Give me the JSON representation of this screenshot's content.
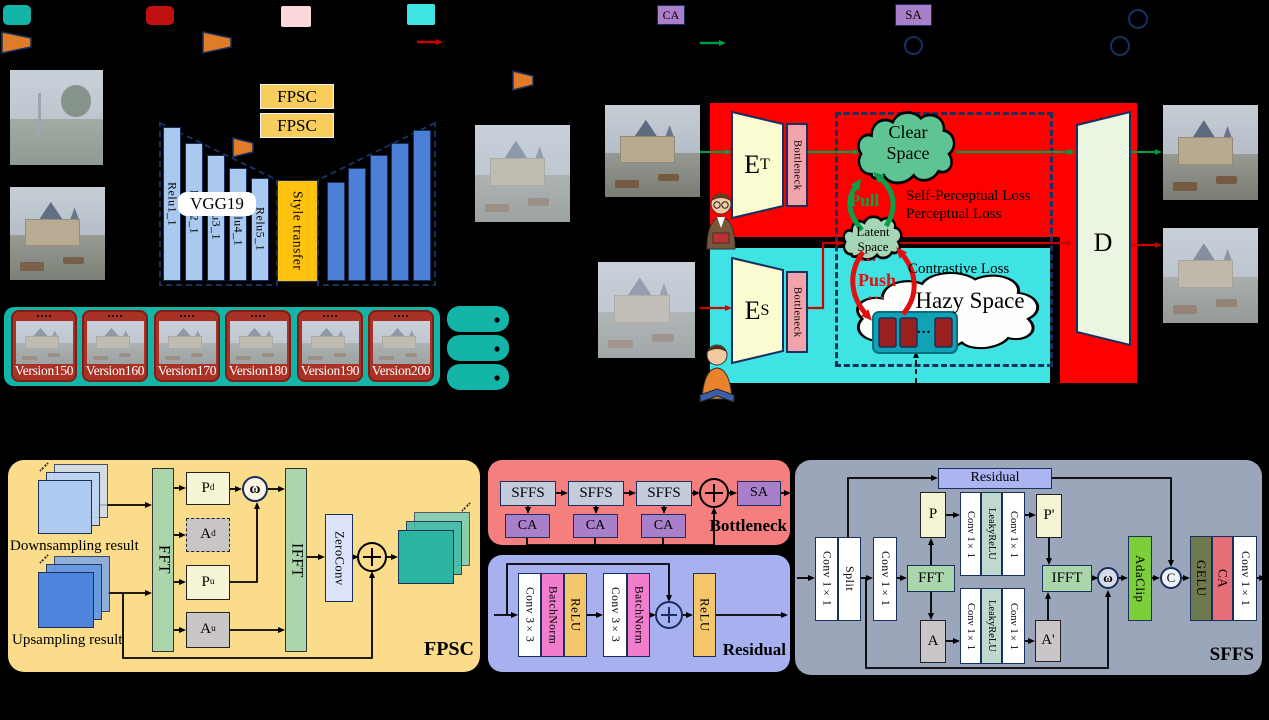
{
  "legend": {
    "ca": "CA",
    "sa": "SA"
  },
  "icons": {
    "omega": "ω",
    "concat": "C",
    "dots": "..."
  },
  "stylization": {
    "fpsc_box_top": "FPSC",
    "fpsc_box_bottom": "FPSC",
    "vgg": "VGG19",
    "relu": [
      "Relu1_1",
      "Relu2_1",
      "Relu3_1",
      "Relu4_1",
      "Relu5_1"
    ],
    "style_transfer": "Style transfer"
  },
  "versions": {
    "labels": [
      "Version150",
      "Version160",
      "Version170",
      "Version180",
      "Version190",
      "Version200"
    ]
  },
  "dual_branch": {
    "teacher_encoder": {
      "main": "E",
      "sub": "T"
    },
    "student_encoder": {
      "main": "E",
      "sub": "S"
    },
    "teacher_bottleneck": "Bottleneck",
    "student_bottleneck": "Bottleneck",
    "clear_space_line1": "Clear",
    "clear_space_line2": "Space",
    "latent_space_line1": "Latent",
    "latent_space_line2": "Space",
    "hazy_space": "Hazy Space",
    "pull": "Pull",
    "push": "Push",
    "self_perceptual_loss": "Self-Perceptual Loss",
    "perceptual_loss": "Perceptual Loss",
    "contrastive_loss": "Contrastive Loss",
    "decoder": "D"
  },
  "fpsc_module": {
    "title": "FPSC",
    "downsampling": "Downsampling result",
    "upsampling": "Upsampling result",
    "fft": "FFT",
    "ifft": "IFFT",
    "zeroconv": "ZeroConv",
    "pd": {
      "main": "P",
      "sub": "d"
    },
    "ad": {
      "main": "A",
      "sub": "d"
    },
    "pu": {
      "main": "P",
      "sub": "u"
    },
    "au": {
      "main": "A",
      "sub": "u"
    }
  },
  "bottleneck_module": {
    "title": "Bottleneck",
    "sffs": [
      "SFFS",
      "SFFS",
      "SFFS"
    ],
    "ca": [
      "CA",
      "CA",
      "CA"
    ],
    "sa": "SA"
  },
  "residual_module": {
    "title": "Residual",
    "conv1": "Conv 3×3",
    "bn1": "BatchNorm",
    "relu1": "ReLU",
    "conv2": "Conv 3×3",
    "bn2": "BatchNorm",
    "relu2": "ReLU"
  },
  "sffs_module": {
    "title": "SFFS",
    "conv_in": "Conv 1×1",
    "split": "Split",
    "conv_mid": "Conv 1×1",
    "fft": "FFT",
    "ifft": "IFFT",
    "p": "P",
    "a": "A",
    "p_prime": "P'",
    "a_prime": "A'",
    "residual": "Residual",
    "p_branch": [
      "Conv 1×1",
      "LeakyReLU",
      "Conv 1×1"
    ],
    "a_branch": [
      "Conv 1×1",
      "LeakyReLU",
      "Conv 1×1"
    ],
    "adaclip": "AdaClip",
    "gelu": "GELU",
    "ca": "CA",
    "conv_out": "Conv 1×1"
  }
}
